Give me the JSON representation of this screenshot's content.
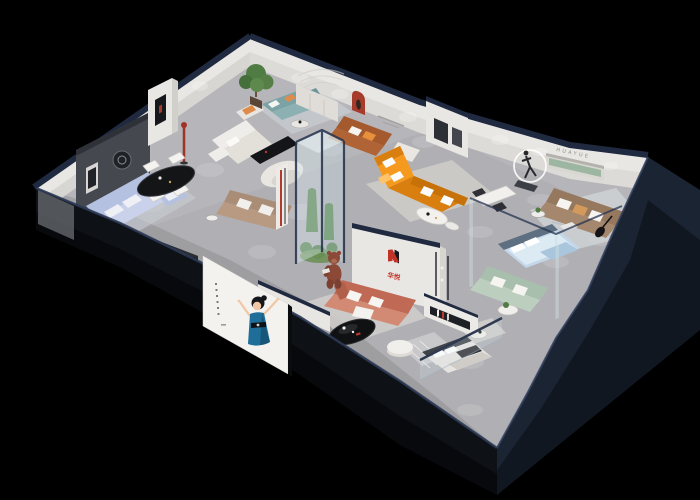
{
  "scene": {
    "description": "3D isometric cutaway render of a furniture showroom floor plan on a black background",
    "view": "axonometric cutaway, walls clipped, spot-lit displays"
  },
  "brand": {
    "wall_letters": "HUAYUE",
    "logo_text": "华悦"
  },
  "poster": {
    "subject": "illustrated hostess in a blue gown with raised arms",
    "side_text_style": "small vertical caption dots (illegible)"
  },
  "colors": {
    "bg": "#000000",
    "floor": "#b0afb3",
    "wall": "#e9e7e3",
    "cap": "#1f2940",
    "fascia": "#0e1116",
    "fascia2": "#1b2433",
    "poster": "#f3f2ef",
    "orange": "#f59a1e",
    "orange_deep": "#d97f10",
    "teal": "#7ba3a5",
    "periwinkle": "#b5c1e0",
    "coral": "#c06a55",
    "coral_light": "#d28a74",
    "sage": "#a8bfad",
    "sage_niche": "#9cb6a2",
    "brown": "#96785f",
    "leather": "#a55a2e",
    "bed_blue": "#c3d7e8",
    "red": "#a63a2b",
    "logo_red": "#c13227",
    "ink": "#141517",
    "plant": "#4e7c42",
    "bear": "#8c4937",
    "glass": "#d7e8ed",
    "skin": "#f0c7a5",
    "dress": "#1e6e99"
  },
  "zones": [
    {
      "name": "dining-area",
      "items": "black oval dining table with four white chairs, red arched niche"
    },
    {
      "name": "blue-sofa-lounge",
      "items": "periwinkle fabric sofa set, ottoman, black media console"
    },
    {
      "name": "feature-wall",
      "items": "dark art wall with framed prints, red display column"
    },
    {
      "name": "cream-sofa-lounge",
      "items": "white sofa with chaise, black TV bench, taupe sofa, curved partition"
    },
    {
      "name": "teal-sofa-lounge",
      "items": "teal sofa, rust armchair, potted tree, white cabinets"
    },
    {
      "name": "leather-sofa-display",
      "items": "tan leather sofa, white armchair, art partition"
    },
    {
      "name": "orange-sectional-display",
      "items": "orange L-shaped sectional, white coffee tables, wall caption"
    },
    {
      "name": "sculpture-display",
      "items": "runner statue inside glowing light ring"
    },
    {
      "name": "taupe-sofa-display",
      "items": "taupe fabric sofa, guitar, green recessed shelf niche"
    },
    {
      "name": "glass-atrium",
      "items": "glass column planter with cacti, mascot bear figure"
    },
    {
      "name": "brand-wall",
      "items": "logo wall, coral sofa, black oval coffee table, white pouf, book shelf"
    },
    {
      "name": "bedroom-display-blue",
      "items": "blue bed, white desk, sage sofa, round table, glass partitions"
    },
    {
      "name": "bedroom-display-gray",
      "items": "gray bed, striped runner rug, glass balustrade"
    },
    {
      "name": "poster-wall",
      "items": "white poster with illustrated hostess on front fascia"
    }
  ]
}
